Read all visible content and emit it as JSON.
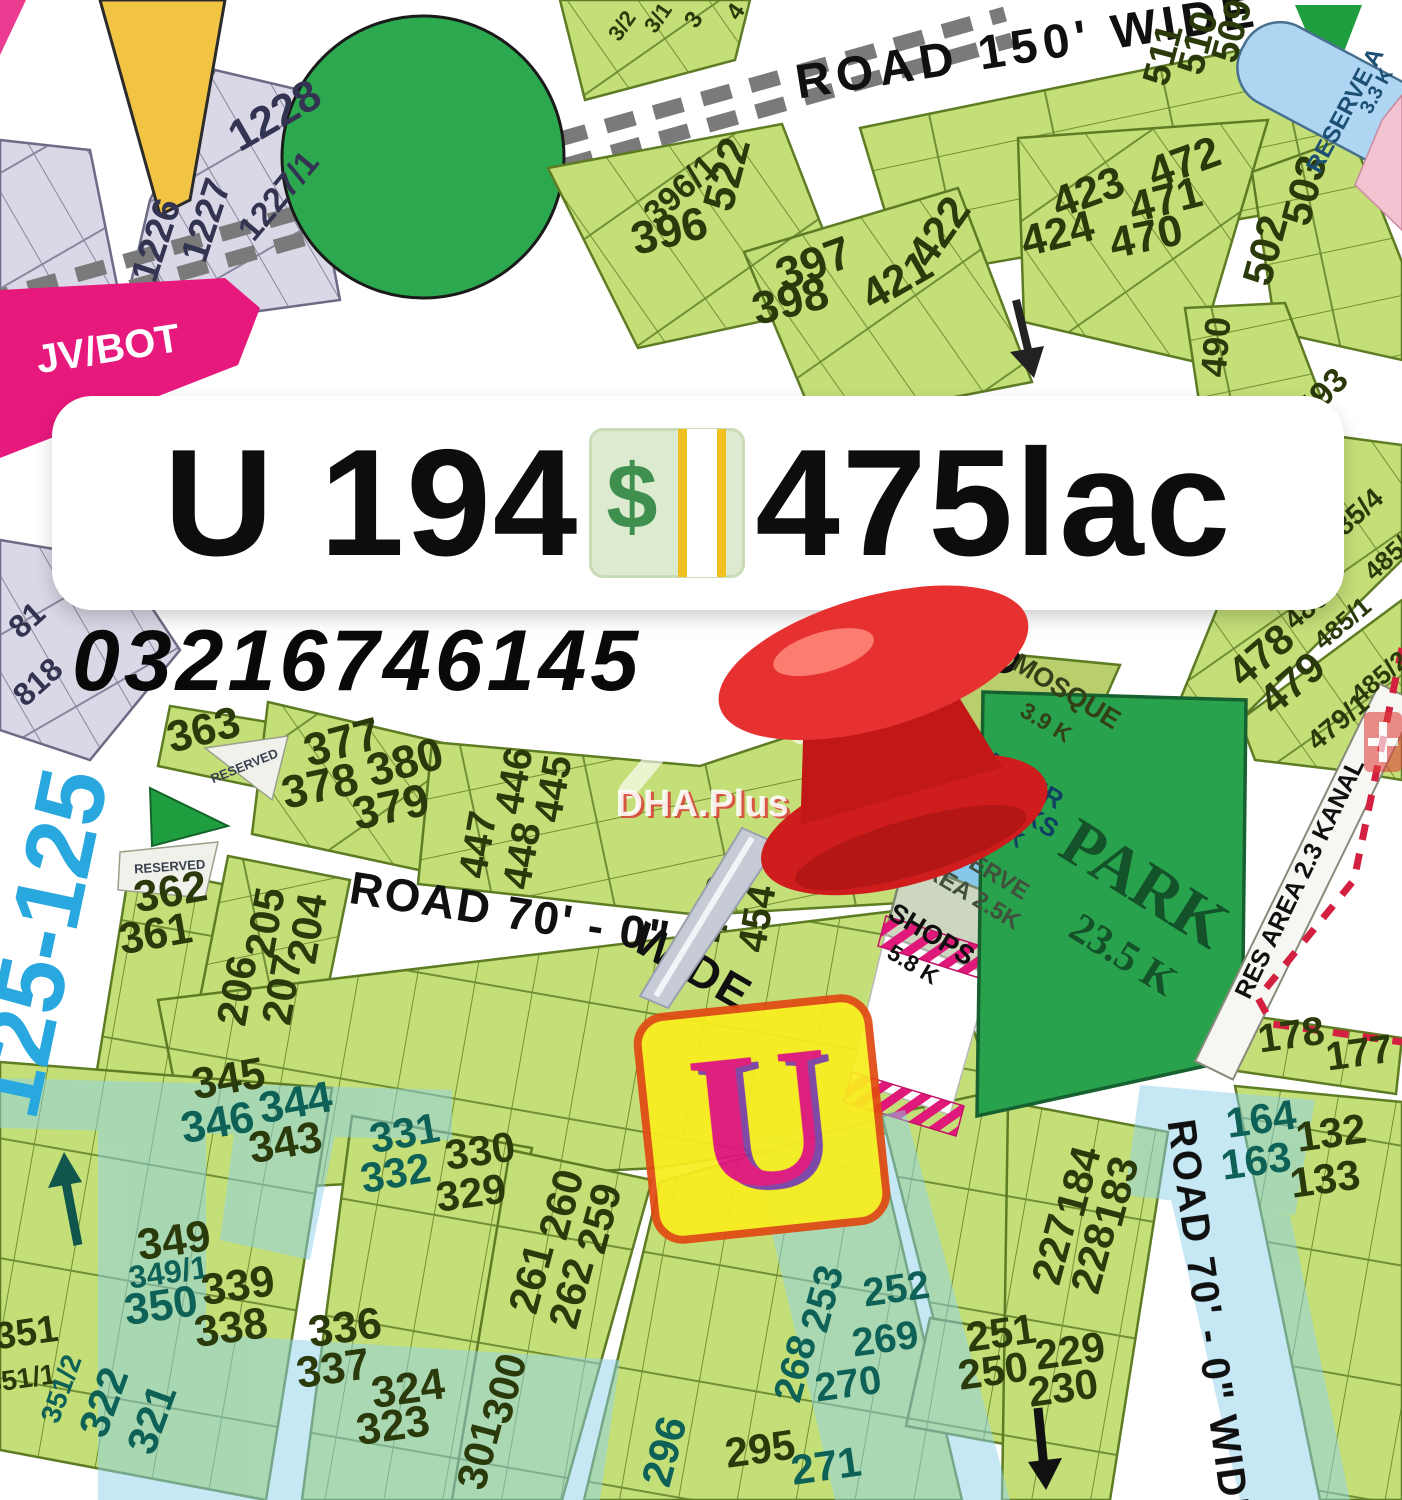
{
  "listing": {
    "title_prefix": "U 194",
    "title_suffix": "475lac",
    "currency_symbol": "$",
    "phone": "03216746145",
    "marker_letter": "U"
  },
  "watermarks": {
    "brand": "DHA.Plus",
    "overlay_road_text": "125-125"
  },
  "palette": {
    "dark": "#2b3a0a",
    "teal": "#0e6156",
    "black": "#101010",
    "white": "#ffffff",
    "cyan": "#29a8df",
    "gplot": "#333352",
    "gtext": "#39414f",
    "mosque": "#333f17",
    "water": "#0f3f63",
    "rescol": "#40503c",
    "park": "#14532a",
    "blue": "#1c4f74",
    "wmred": "#d9453a",
    "plot_green": "#c4df78",
    "park_green": "#28a24c",
    "magenta": "#e8197d",
    "gray_plot": "#dad7e6",
    "reserve_blue": "#aed6f2"
  },
  "map": {
    "labels": [
      {
        "t": "1228",
        "x": 282,
        "y": 128,
        "r": -30,
        "s": 44,
        "c": "gplot"
      },
      {
        "t": "1227/1",
        "x": 287,
        "y": 203,
        "r": -50,
        "s": 34,
        "c": "gplot"
      },
      {
        "t": "1227",
        "x": 218,
        "y": 224,
        "r": -72,
        "s": 38,
        "c": "gplot"
      },
      {
        "t": "1226",
        "x": 168,
        "y": 244,
        "r": -72,
        "s": 38,
        "c": "gplot"
      },
      {
        "t": "81",
        "x": 34,
        "y": 628,
        "r": -42,
        "s": 32,
        "c": "gplot"
      },
      {
        "t": "818",
        "x": 45,
        "y": 690,
        "r": -42,
        "s": 32,
        "c": "gplot"
      },
      {
        "t": "JV/BOT",
        "x": 110,
        "y": 362,
        "r": -9,
        "s": 40,
        "c": "white"
      },
      {
        "t": "3/2",
        "x": 628,
        "y": 30,
        "r": -55,
        "s": 22,
        "c": "dark"
      },
      {
        "t": "3/1",
        "x": 664,
        "y": 22,
        "r": -55,
        "s": 22,
        "c": "dark"
      },
      {
        "t": "3",
        "x": 700,
        "y": 24,
        "r": -55,
        "s": 24,
        "c": "dark"
      },
      {
        "t": "4",
        "x": 742,
        "y": 16,
        "r": -55,
        "s": 24,
        "c": "dark"
      },
      {
        "t": "ROAD 150' WIDE",
        "x": 1030,
        "y": 62,
        "r": -9,
        "s": 48,
        "c": "black",
        "ls": 6
      },
      {
        "t": "522",
        "x": 741,
        "y": 178,
        "r": -75,
        "s": 44,
        "c": "dark"
      },
      {
        "t": "396/1",
        "x": 688,
        "y": 198,
        "r": -42,
        "s": 34,
        "c": "dark"
      },
      {
        "t": "396",
        "x": 673,
        "y": 246,
        "r": -14,
        "s": 46,
        "c": "dark"
      },
      {
        "t": "397",
        "x": 819,
        "y": 278,
        "r": -20,
        "s": 46,
        "c": "dark"
      },
      {
        "t": "398",
        "x": 794,
        "y": 316,
        "r": -14,
        "s": 46,
        "c": "dark"
      },
      {
        "t": "421",
        "x": 904,
        "y": 293,
        "r": -30,
        "s": 44,
        "c": "dark"
      },
      {
        "t": "422",
        "x": 951,
        "y": 240,
        "r": -55,
        "s": 44,
        "c": "dark"
      },
      {
        "t": "423",
        "x": 1093,
        "y": 206,
        "r": -20,
        "s": 44,
        "c": "dark"
      },
      {
        "t": "424",
        "x": 1061,
        "y": 248,
        "r": -14,
        "s": 44,
        "c": "dark"
      },
      {
        "t": "472",
        "x": 1189,
        "y": 176,
        "r": -20,
        "s": 44,
        "c": "dark"
      },
      {
        "t": "471",
        "x": 1169,
        "y": 214,
        "r": -14,
        "s": 44,
        "c": "dark"
      },
      {
        "t": "470",
        "x": 1149,
        "y": 251,
        "r": -12,
        "s": 44,
        "c": "dark"
      },
      {
        "t": "509",
        "x": 1244,
        "y": 34,
        "r": -75,
        "s": 38,
        "c": "dark"
      },
      {
        "t": "510",
        "x": 1210,
        "y": 46,
        "r": -75,
        "s": 38,
        "c": "dark"
      },
      {
        "t": "511",
        "x": 1175,
        "y": 58,
        "r": -75,
        "s": 38,
        "c": "dark"
      },
      {
        "t": "502",
        "x": 1279,
        "y": 254,
        "r": -75,
        "s": 42,
        "c": "dark"
      },
      {
        "t": "503",
        "x": 1318,
        "y": 194,
        "r": -75,
        "s": 42,
        "c": "dark"
      },
      {
        "t": "490",
        "x": 1228,
        "y": 348,
        "r": -85,
        "s": 36,
        "c": "dark"
      },
      {
        "t": "493",
        "x": 1330,
        "y": 402,
        "r": -45,
        "s": 34,
        "c": "dark"
      },
      {
        "t": "RESERVE A",
        "x": 1352,
        "y": 114,
        "r": -62,
        "s": 24,
        "c": "blue"
      },
      {
        "t": "3.3 K",
        "x": 1382,
        "y": 94,
        "r": -62,
        "s": 20,
        "c": "blue"
      },
      {
        "t": "485/4",
        "x": 1359,
        "y": 524,
        "r": -42,
        "s": 28,
        "c": "dark"
      },
      {
        "t": "485/3",
        "x": 1398,
        "y": 560,
        "r": -42,
        "s": 26,
        "c": "dark"
      },
      {
        "t": "478",
        "x": 1270,
        "y": 666,
        "r": -40,
        "s": 42,
        "c": "dark"
      },
      {
        "t": "480",
        "x": 1312,
        "y": 616,
        "r": -40,
        "s": 28,
        "c": "dark"
      },
      {
        "t": "485/1",
        "x": 1348,
        "y": 630,
        "r": -40,
        "s": 26,
        "c": "dark"
      },
      {
        "t": "479",
        "x": 1301,
        "y": 694,
        "r": -40,
        "s": 42,
        "c": "dark"
      },
      {
        "t": "485/2",
        "x": 1385,
        "y": 684,
        "r": -40,
        "s": 26,
        "c": "dark"
      },
      {
        "t": "479/1",
        "x": 1344,
        "y": 729,
        "r": -40,
        "s": 28,
        "c": "dark"
      },
      {
        "t": "RES AREA 2.3 KANAL",
        "x": 1307,
        "y": 882,
        "r": -64,
        "s": 25,
        "c": "black"
      },
      {
        "t": "178",
        "x": 1293,
        "y": 1048,
        "r": -8,
        "s": 40,
        "c": "dark"
      },
      {
        "t": "177",
        "x": 1361,
        "y": 1066,
        "r": -8,
        "s": 40,
        "c": "dark"
      },
      {
        "t": "363",
        "x": 207,
        "y": 744,
        "r": -14,
        "s": 44,
        "c": "dark"
      },
      {
        "t": "RESERVED",
        "x": 246,
        "y": 770,
        "r": -22,
        "s": 13,
        "c": "gtext"
      },
      {
        "t": "RESERVED",
        "x": 170,
        "y": 871,
        "r": -4,
        "s": 13,
        "c": "gtext"
      },
      {
        "t": "362",
        "x": 173,
        "y": 906,
        "r": -10,
        "s": 44,
        "c": "dark"
      },
      {
        "t": "361",
        "x": 158,
        "y": 948,
        "r": -10,
        "s": 44,
        "c": "dark"
      },
      {
        "t": "125-125",
        "x": 72,
        "y": 950,
        "r": -78,
        "s": 96,
        "c": "cyan"
      },
      {
        "t": "377",
        "x": 346,
        "y": 757,
        "r": -15,
        "s": 46,
        "c": "dark"
      },
      {
        "t": "380",
        "x": 409,
        "y": 777,
        "r": -15,
        "s": 46,
        "c": "dark"
      },
      {
        "t": "378",
        "x": 323,
        "y": 801,
        "r": -12,
        "s": 46,
        "c": "dark"
      },
      {
        "t": "379",
        "x": 394,
        "y": 822,
        "r": -12,
        "s": 46,
        "c": "dark"
      },
      {
        "t": "205",
        "x": 279,
        "y": 925,
        "r": -80,
        "s": 42,
        "c": "dark"
      },
      {
        "t": "204",
        "x": 321,
        "y": 931,
        "r": -80,
        "s": 42,
        "c": "dark"
      },
      {
        "t": "206",
        "x": 251,
        "y": 993,
        "r": -80,
        "s": 42,
        "c": "dark"
      },
      {
        "t": "207",
        "x": 296,
        "y": 992,
        "r": -80,
        "s": 42,
        "c": "dark"
      },
      {
        "t": "ROAD 70' - 0\"",
        "x": 508,
        "y": 928,
        "r": 9,
        "s": 46,
        "c": "black",
        "ls": 2
      },
      {
        "t": "WIDE",
        "x": 685,
        "y": 980,
        "r": 30,
        "s": 46,
        "c": "black",
        "ls": 2
      },
      {
        "t": "RO",
        "x": 984,
        "y": 655,
        "r": 52,
        "s": 42,
        "c": "black"
      },
      {
        "t": "446",
        "x": 527,
        "y": 783,
        "r": -80,
        "s": 40,
        "c": "dark"
      },
      {
        "t": "445",
        "x": 566,
        "y": 791,
        "r": -80,
        "s": 40,
        "c": "dark"
      },
      {
        "t": "447",
        "x": 491,
        "y": 847,
        "r": -80,
        "s": 40,
        "c": "dark"
      },
      {
        "t": "448",
        "x": 535,
        "y": 858,
        "r": -80,
        "s": 40,
        "c": "dark"
      },
      {
        "t": "453",
        "x": 730,
        "y": 911,
        "r": -80,
        "s": 40,
        "c": "dark"
      },
      {
        "t": "454",
        "x": 770,
        "y": 921,
        "r": -80,
        "s": 40,
        "c": "dark"
      },
      {
        "t": "56",
        "x": 874,
        "y": 757,
        "r": -12,
        "s": 38,
        "c": "dark"
      },
      {
        "t": "55",
        "x": 857,
        "y": 800,
        "r": -12,
        "s": 38,
        "c": "dark"
      },
      {
        "t": "MOSQUE",
        "x": 1062,
        "y": 699,
        "r": 31,
        "s": 27,
        "c": "mosque"
      },
      {
        "t": "3.9 K",
        "x": 1042,
        "y": 729,
        "r": 31,
        "s": 23,
        "c": "mosque"
      },
      {
        "t": "WATER",
        "x": 1017,
        "y": 786,
        "r": 31,
        "s": 26,
        "c": "water"
      },
      {
        "t": "WORKS",
        "x": 1009,
        "y": 813,
        "r": 31,
        "s": 26,
        "c": "water"
      },
      {
        "t": "4.5 K",
        "x": 996,
        "y": 835,
        "r": 31,
        "s": 22,
        "c": "water"
      },
      {
        "t": "RESERVE",
        "x": 974,
        "y": 871,
        "r": 31,
        "s": 24,
        "c": "rescol"
      },
      {
        "t": "AREA 2.5K",
        "x": 961,
        "y": 898,
        "r": 31,
        "s": 24,
        "c": "rescol"
      },
      {
        "t": "SHOPS",
        "x": 927,
        "y": 942,
        "r": 31,
        "s": 27,
        "c": "black"
      },
      {
        "t": "5.8 K",
        "x": 909,
        "y": 971,
        "r": 31,
        "s": 23,
        "c": "black"
      },
      {
        "t": "PARK",
        "x": 1133,
        "y": 902,
        "r": 32,
        "s": 66,
        "c": "park",
        "f": "serif"
      },
      {
        "t": "23.5 K",
        "x": 1116,
        "y": 966,
        "r": 32,
        "s": 42,
        "c": "park",
        "f": "serif"
      },
      {
        "t": "345",
        "x": 231,
        "y": 1093,
        "r": -10,
        "s": 44,
        "c": "dark"
      },
      {
        "t": "344",
        "x": 298,
        "y": 1117,
        "r": -10,
        "s": 44,
        "c": "teal"
      },
      {
        "t": "346",
        "x": 220,
        "y": 1137,
        "r": -10,
        "s": 44,
        "c": "teal"
      },
      {
        "t": "343",
        "x": 288,
        "y": 1157,
        "r": -10,
        "s": 44,
        "c": "dark"
      },
      {
        "t": "331",
        "x": 407,
        "y": 1147,
        "r": -10,
        "s": 42,
        "c": "teal"
      },
      {
        "t": "330",
        "x": 482,
        "y": 1165,
        "r": -8,
        "s": 42,
        "c": "dark"
      },
      {
        "t": "332",
        "x": 398,
        "y": 1187,
        "r": -10,
        "s": 42,
        "c": "teal"
      },
      {
        "t": "329",
        "x": 473,
        "y": 1207,
        "r": -8,
        "s": 42,
        "c": "dark"
      },
      {
        "t": "349",
        "x": 176,
        "y": 1255,
        "r": -8,
        "s": 44,
        "c": "dark"
      },
      {
        "t": "349/1",
        "x": 170,
        "y": 1283,
        "r": -8,
        "s": 32,
        "c": "teal"
      },
      {
        "t": "350",
        "x": 163,
        "y": 1320,
        "r": -8,
        "s": 44,
        "c": "teal"
      },
      {
        "t": "339",
        "x": 240,
        "y": 1300,
        "r": -8,
        "s": 44,
        "c": "dark"
      },
      {
        "t": "338",
        "x": 233,
        "y": 1342,
        "r": -8,
        "s": 44,
        "c": "dark"
      },
      {
        "t": "336",
        "x": 347,
        "y": 1342,
        "r": -8,
        "s": 44,
        "c": "dark"
      },
      {
        "t": "337",
        "x": 335,
        "y": 1383,
        "r": -8,
        "s": 44,
        "c": "dark"
      },
      {
        "t": "324",
        "x": 410,
        "y": 1403,
        "r": -8,
        "s": 44,
        "c": "dark"
      },
      {
        "t": "323",
        "x": 395,
        "y": 1440,
        "r": -8,
        "s": 44,
        "c": "dark"
      },
      {
        "t": "351",
        "x": 28,
        "y": 1345,
        "r": -8,
        "s": 38,
        "c": "dark"
      },
      {
        "t": "351/1",
        "x": 22,
        "y": 1388,
        "r": -8,
        "s": 28,
        "c": "dark"
      },
      {
        "t": "351/2",
        "x": 70,
        "y": 1392,
        "r": -70,
        "s": 28,
        "c": "teal"
      },
      {
        "t": "322",
        "x": 117,
        "y": 1407,
        "r": -70,
        "s": 42,
        "c": "teal"
      },
      {
        "t": "321",
        "x": 165,
        "y": 1424,
        "r": -70,
        "s": 42,
        "c": "teal"
      },
      {
        "t": "260",
        "x": 575,
        "y": 1208,
        "r": -75,
        "s": 42,
        "c": "dark"
      },
      {
        "t": "259",
        "x": 613,
        "y": 1222,
        "r": -75,
        "s": 42,
        "c": "dark"
      },
      {
        "t": "261",
        "x": 545,
        "y": 1282,
        "r": -75,
        "s": 42,
        "c": "dark"
      },
      {
        "t": "262",
        "x": 585,
        "y": 1297,
        "r": -75,
        "s": 42,
        "c": "dark"
      },
      {
        "t": "300",
        "x": 518,
        "y": 1392,
        "r": -75,
        "s": 42,
        "c": "dark"
      },
      {
        "t": "301",
        "x": 493,
        "y": 1458,
        "r": -75,
        "s": 42,
        "c": "dark"
      },
      {
        "t": "296",
        "x": 678,
        "y": 1455,
        "r": -75,
        "s": 42,
        "c": "teal"
      },
      {
        "t": "295",
        "x": 762,
        "y": 1463,
        "r": -8,
        "s": 42,
        "c": "dark"
      },
      {
        "t": "271",
        "x": 828,
        "y": 1480,
        "r": -8,
        "s": 42,
        "c": "teal"
      },
      {
        "t": "268",
        "x": 808,
        "y": 1372,
        "r": -75,
        "s": 40,
        "c": "teal"
      },
      {
        "t": "253",
        "x": 835,
        "y": 1302,
        "r": -75,
        "s": 40,
        "c": "teal"
      },
      {
        "t": "270",
        "x": 850,
        "y": 1397,
        "r": -8,
        "s": 40,
        "c": "teal"
      },
      {
        "t": "269",
        "x": 887,
        "y": 1352,
        "r": -8,
        "s": 40,
        "c": "teal"
      },
      {
        "t": "252",
        "x": 898,
        "y": 1302,
        "r": -8,
        "s": 40,
        "c": "teal"
      },
      {
        "t": "251",
        "x": 1003,
        "y": 1347,
        "r": -8,
        "s": 42,
        "c": "dark"
      },
      {
        "t": "229",
        "x": 1072,
        "y": 1365,
        "r": -8,
        "s": 42,
        "c": "dark"
      },
      {
        "t": "250",
        "x": 995,
        "y": 1385,
        "r": -8,
        "s": 42,
        "c": "dark"
      },
      {
        "t": "230",
        "x": 1065,
        "y": 1402,
        "r": -8,
        "s": 42,
        "c": "dark"
      },
      {
        "t": "227",
        "x": 1068,
        "y": 1253,
        "r": -75,
        "s": 42,
        "c": "dark"
      },
      {
        "t": "228",
        "x": 1107,
        "y": 1262,
        "r": -75,
        "s": 42,
        "c": "dark"
      },
      {
        "t": "184",
        "x": 1092,
        "y": 1185,
        "r": -75,
        "s": 42,
        "c": "dark"
      },
      {
        "t": "183",
        "x": 1130,
        "y": 1195,
        "r": -75,
        "s": 42,
        "c": "dark"
      },
      {
        "t": "164",
        "x": 1263,
        "y": 1133,
        "r": -8,
        "s": 42,
        "c": "teal"
      },
      {
        "t": "132",
        "x": 1333,
        "y": 1147,
        "r": -8,
        "s": 42,
        "c": "dark"
      },
      {
        "t": "163",
        "x": 1258,
        "y": 1175,
        "r": -8,
        "s": 42,
        "c": "teal"
      },
      {
        "t": "133",
        "x": 1327,
        "y": 1193,
        "r": -8,
        "s": 42,
        "c": "dark"
      },
      {
        "t": "ROAD 70' - 0\" WIDE",
        "x": 1196,
        "y": 1325,
        "r": 82,
        "s": 40,
        "c": "black",
        "ls": 2
      },
      {
        "t": "DHA.Plus",
        "x": 702,
        "y": 816,
        "r": 0,
        "s": 38,
        "c": "white",
        "o": 0.88,
        "sh": 1
      }
    ]
  }
}
